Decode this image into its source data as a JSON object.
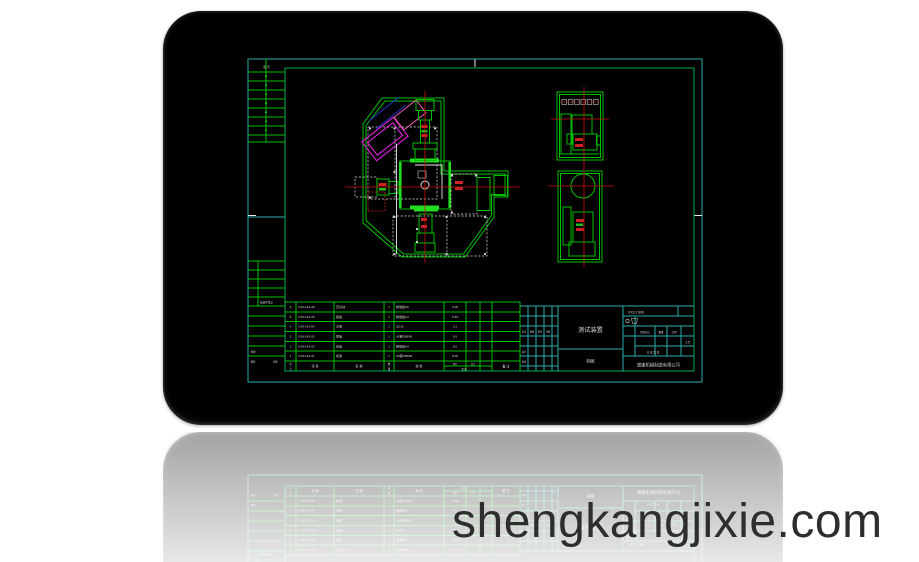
{
  "watermark": "shengkangjixie.com",
  "colors": {
    "frame_cyan": "#2aabab",
    "entity_green": "#00c000",
    "centerline_red": "#cc1111",
    "highlight_magenta": "#e020e0",
    "aux_blue": "#2233cc",
    "text_white": "#dddddd",
    "screen_black": "#000000"
  },
  "margin_strip": {
    "top_label": "签 字",
    "register_label": "借用件登记",
    "trace_label": "描图",
    "check_label": "描校",
    "date_label": "日期"
  },
  "bom": {
    "headers": {
      "seq_top": "序",
      "seq_bottom": "号",
      "code": "代 号",
      "name": "名 称",
      "qty_top": "数",
      "qty_bottom": "量",
      "material": "材 料",
      "unit": "单件",
      "total": "总计",
      "weight": "重 量",
      "remark": "备 注"
    },
    "rows": [
      {
        "seq": "6",
        "code": "XJN-142-06",
        "name": "定位块",
        "qty": "1",
        "material": "橡胶板δ6",
        "weight": "0.05"
      },
      {
        "seq": "5",
        "code": "XJN-142-05",
        "name": "垫板",
        "qty": "1",
        "material": "橡胶板δ4",
        "weight": "0.83"
      },
      {
        "seq": "4",
        "code": "XJN-142-04",
        "name": "支架",
        "qty": "1",
        "material": "Q235",
        "weight": "3.2"
      },
      {
        "seq": "3",
        "code": "XJN-142-03",
        "name": "底板",
        "qty": "1",
        "material": "45钢GB699",
        "weight": "0.5"
      },
      {
        "seq": "2",
        "code": "XJN-142-02",
        "name": "压板",
        "qty": "1",
        "material": "橡胶板δ4",
        "weight": "8.0"
      },
      {
        "seq": "1",
        "code": "XJN-142-01",
        "name": "机架",
        "qty": "1",
        "material": "45钢GB699",
        "weight": "8.05"
      }
    ]
  },
  "change_block": {
    "headers": [
      "标记",
      "处数",
      "签名",
      "日期"
    ],
    "sign_labels": [
      "设计",
      "审核"
    ]
  },
  "title_block": {
    "code": "VX3.2 808",
    "title": "测试装置",
    "subtitle": "制图",
    "company": "盛康机械制造有限公司",
    "stage_label": "阶段标记",
    "weight_label": "重量",
    "scale_label": "比例",
    "scale_value": "1:5",
    "sheets": "共 张 第 张"
  }
}
